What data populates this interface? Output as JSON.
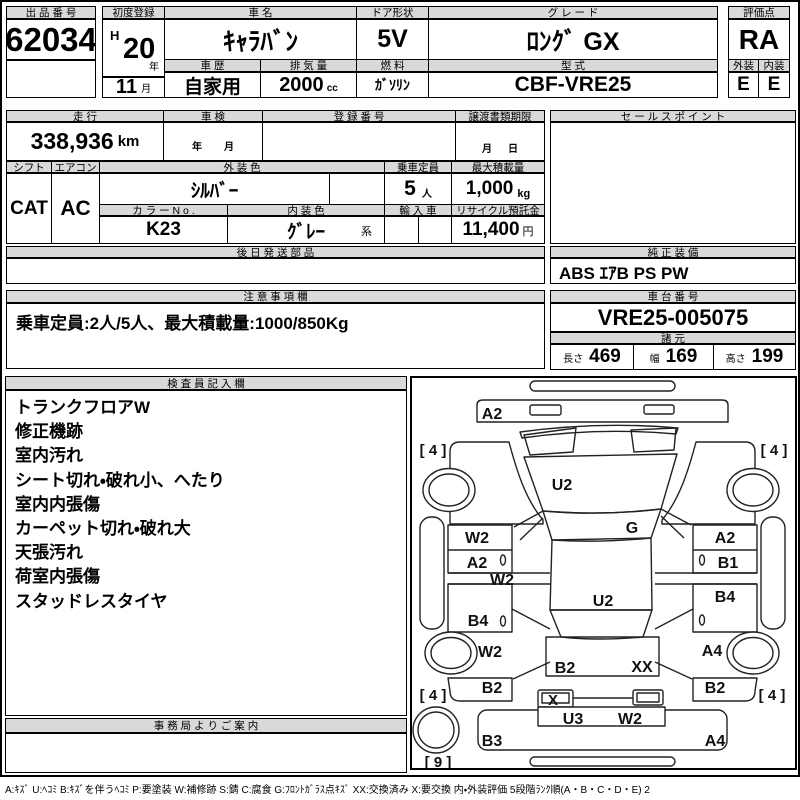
{
  "top": {
    "lot": {
      "header": "出 品 番 号",
      "number": "62034"
    },
    "first_reg": {
      "header": "初度登録",
      "era": "H",
      "year": "20",
      "year_unit": "年",
      "month": "11",
      "month_unit": "月"
    },
    "car_name": {
      "header": "車  名",
      "value": "ｷｬﾗﾊﾞﾝ"
    },
    "door": {
      "header": "ドア形状",
      "value": "5V"
    },
    "grade": {
      "header": "グ レ ー ド",
      "value": "ﾛﾝｸﾞ GX"
    },
    "score": {
      "header": "評価点",
      "value": "RA"
    },
    "history": {
      "header": "車 歴",
      "value": "自家用"
    },
    "displacement": {
      "header": "排 気 量",
      "value": "2000",
      "unit": "cc"
    },
    "fuel": {
      "header": "燃 料",
      "value": "ｶﾞｿﾘﾝ"
    },
    "model": {
      "header": "型 式",
      "value": "CBF-VRE25"
    },
    "ext_grade": {
      "header": "外装",
      "value": "E"
    },
    "int_grade": {
      "header": "内装",
      "value": "E"
    }
  },
  "mid": {
    "mileage": {
      "header": "走 行",
      "value": "338,936",
      "unit": "km"
    },
    "inspection": {
      "header": "車 検",
      "year_label": "年",
      "month_label": "月"
    },
    "reg_number": {
      "header": "登 録 番 号",
      "value": ""
    },
    "transfer": {
      "header": "譲渡書類期限",
      "month_label": "月",
      "day_label": "日"
    },
    "sales_point": {
      "header": "セ ー ル ス ポ イ ン ト",
      "value": ""
    },
    "shift": {
      "header": "シフト",
      "value": "CAT"
    },
    "aircon": {
      "header": "エアコン",
      "value": "AC"
    },
    "ext_color": {
      "header": "外 装 色",
      "value": "ｼﾙﾊﾞｰ"
    },
    "color_no": {
      "header": "カ ラ ー N o .",
      "value": "K23"
    },
    "int_color": {
      "header": "内 装 色",
      "value": "ｸﾞﾚｰ",
      "suffix": "系"
    },
    "capacity": {
      "header": "乗車定員",
      "value": "5",
      "unit": "人"
    },
    "max_load": {
      "header": "最大積載量",
      "value": "1,000",
      "unit": "kg"
    },
    "import_car": {
      "header": "輸 入 車",
      "value": ""
    },
    "recycle": {
      "header": "リサイクル預託金",
      "value": "11,400",
      "unit": "円"
    },
    "later_parts": {
      "header": "後 日 発 送 部 品",
      "value": ""
    },
    "oem_equipment": {
      "header": "純 正 装 備",
      "value": "ABS ｴｱB PS PW"
    },
    "notes": {
      "header": "注 意 事 項 欄",
      "value": "乗車定員:2人/5人、最大積載量:1000/850Kg"
    },
    "chassis": {
      "header": "車 台 番 号",
      "value": "VRE25-005075"
    },
    "specs": {
      "header": "諸 元",
      "length_label": "長さ",
      "length": "469",
      "width_label": "幅",
      "width": "169",
      "height_label": "高さ",
      "height": "199"
    }
  },
  "inspector": {
    "header": "検 査 員 記 入 欄",
    "lines": [
      "トランクフロアW",
      "修正機跡",
      "室内汚れ",
      "シート切れ・破れ小、へたり",
      "室内内張傷",
      "カーペット切れ・破れ大",
      "天張汚れ",
      "荷室内張傷",
      "スタッドレスタイヤ"
    ]
  },
  "office": {
    "header": "事 務 局 よ り ご 案 内",
    "value": ""
  },
  "diagram": {
    "labels": {
      "front_panel": "A2",
      "front_left_tire": "[ 4 ]",
      "front_right_tire": "[ 4 ]",
      "windshield": "U2",
      "cowl": "G",
      "left_door_upper": "W2",
      "left_door_lower": "A2",
      "left_rail": "W2",
      "right_door_upper": "A2",
      "right_door_lower": "B1",
      "left_slide_panel": "B4",
      "right_slide_panel": "B4",
      "roof": "U2",
      "left_quarter": "W2",
      "right_quarter": "A4",
      "rear_panel_left": "B2",
      "rear_panel_right": "XX",
      "left_rear_corner": "B2",
      "right_rear_corner": "B2",
      "rear_left_tire": "[ 4 ]",
      "rear_right_tire": "[ 4 ]",
      "tail_lamp": "X",
      "rear_gate_left": "U3",
      "rear_gate_right": "W2",
      "rear_bumper_left": "B3",
      "rear_bumper_right": "A4",
      "spare_tire": "[ 9 ]"
    }
  },
  "legend": "A:ｷｽﾞ U:ﾍｺﾐ B:ｷｽﾞを伴うﾍｺﾐ P:要塗装 W:補修跡 S:錆 C:腐食 G:ﾌﾛﾝﾄｶﾞﾗｽ点ｷｽﾞ XX:交換済み X:要交換  内・外装評価 5段階ﾗﾝｸ順(A・B・C・D・E) 2"
}
